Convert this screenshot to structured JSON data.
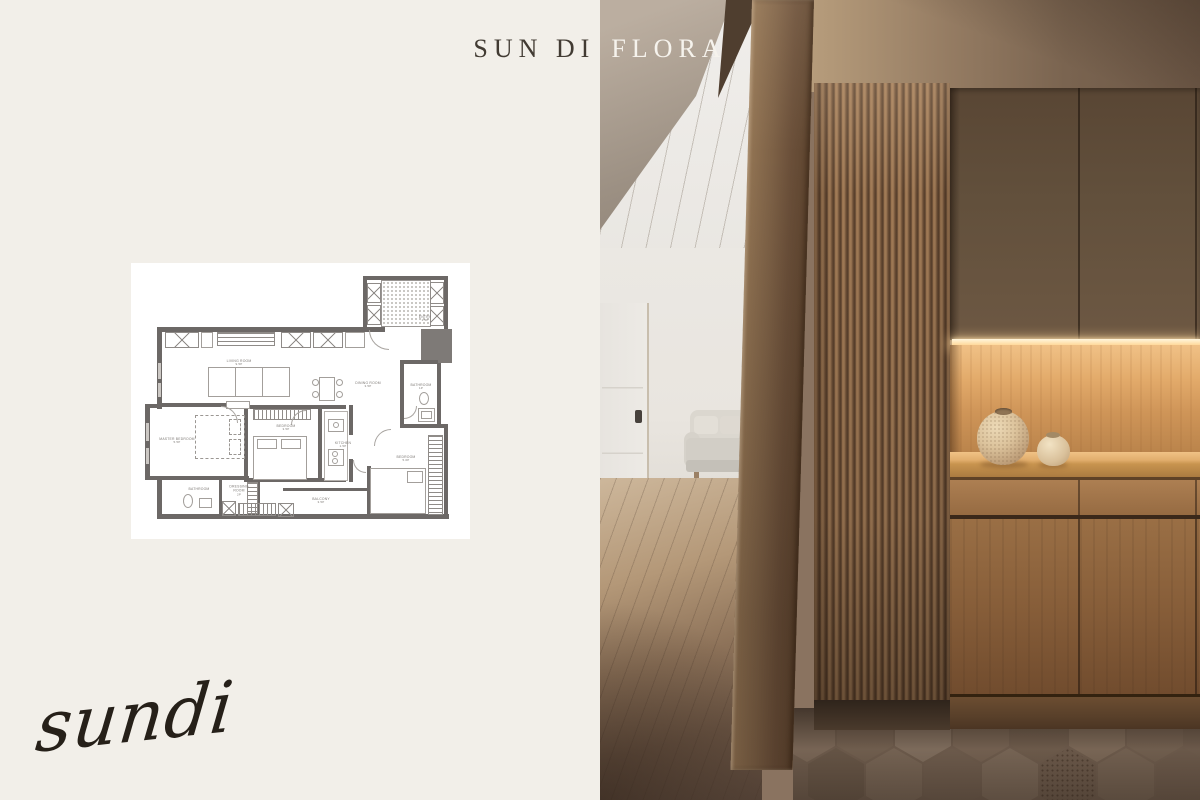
{
  "brand": {
    "title_left": "SUN DI",
    "title_right": "FLORA",
    "signature": "sundi"
  },
  "palette": {
    "background": "#f2efe9",
    "card": "#ffffff",
    "title_dark": "#423b33",
    "title_light": "#f6f3ed",
    "plan_wall": "#6c6866",
    "wood_accent": "#7c5c40",
    "niche_light": "#f0c186"
  },
  "floor_plan": {
    "rooms": [
      {
        "name": "LIVING ROOM",
        "area": "9.5P"
      },
      {
        "name": "DINING ROOM",
        "area": "3.5P"
      },
      {
        "name": "MASTER BEDROOM",
        "area": "5.5P"
      },
      {
        "name": "BEDROOM",
        "area": "3.5P"
      },
      {
        "name": "KITCHEN",
        "area": "1.5P"
      },
      {
        "name": "BATHROOM",
        "area": "1P"
      },
      {
        "name": "BEDROOM",
        "area": "5.0P"
      },
      {
        "name": "BATHROOM",
        "area": ""
      },
      {
        "name": "DRESSING ROOM",
        "area": "2P"
      },
      {
        "name": "BALCONY",
        "area": "3.5P"
      },
      {
        "name": "ENTRY",
        "area": "1.5P"
      }
    ]
  }
}
